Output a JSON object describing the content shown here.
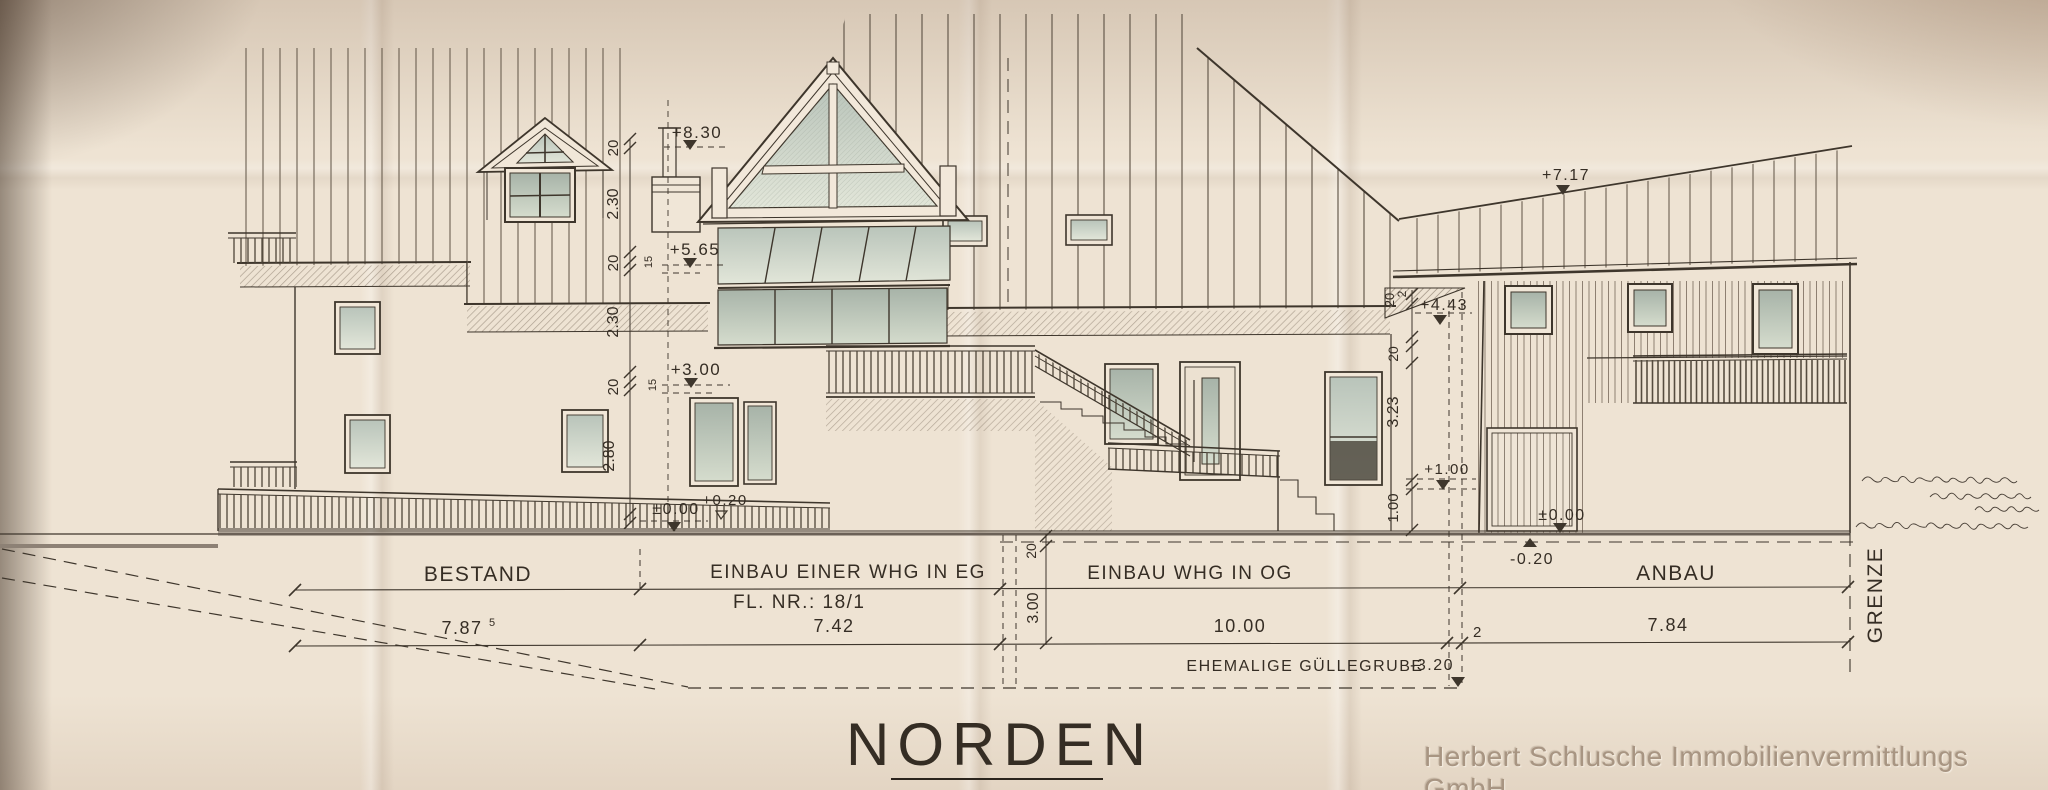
{
  "title": {
    "text": "NORDEN"
  },
  "watermark": {
    "text": "Herbert Schlusche Immobilienvermittlungs GmbH"
  },
  "section_labels": {
    "bestand": "BESTAND",
    "einbau_eg_line1": "EINBAU EINER WHG IN EG",
    "einbau_eg_line2": "FL. NR.: 18/1",
    "einbau_og": "EINBAU WHG IN OG",
    "anbau": "ANBAU",
    "grenze": "GRENZE",
    "guellegrube": "EHEMALIGE GÜLLEGRUBE"
  },
  "dims_horizontal": {
    "bestand": "7.87",
    "bestand_sup": "5",
    "eg": "7.42",
    "og": "10.00",
    "gap": "2",
    "anbau": "7.84"
  },
  "levels": {
    "ridge_left": "+8.30",
    "mid": "+5.65",
    "upper_floor": "+3.00",
    "terrace_zero": "±0.00",
    "terrace_plus": "+0.20",
    "ridge_anbau": "+7.17",
    "anbau_eave": "+4.43",
    "anbau_plus1": "+1.00",
    "anbau_zero": "±0.00",
    "ground_minus": "-0.20",
    "pit_depth": "-3.20"
  },
  "dims_vertical_left": {
    "v1": "20",
    "v2": "2.30",
    "v3": "20",
    "v3s": "15",
    "v4": "2.30",
    "v5": "20",
    "v5s": "15",
    "v6": "2.80"
  },
  "dims_vertical_mid": {
    "v1": "20",
    "v2": "3.00"
  },
  "dims_vertical_right": {
    "v0a": "20",
    "v0b": "2",
    "v1": "20",
    "v2": "3.23",
    "v3": "1.00"
  },
  "colors": {
    "paper": "#eee3d3",
    "ink": "#3e362c",
    "glass": "#c3cdc3",
    "shadow": "#9a8d7e"
  }
}
